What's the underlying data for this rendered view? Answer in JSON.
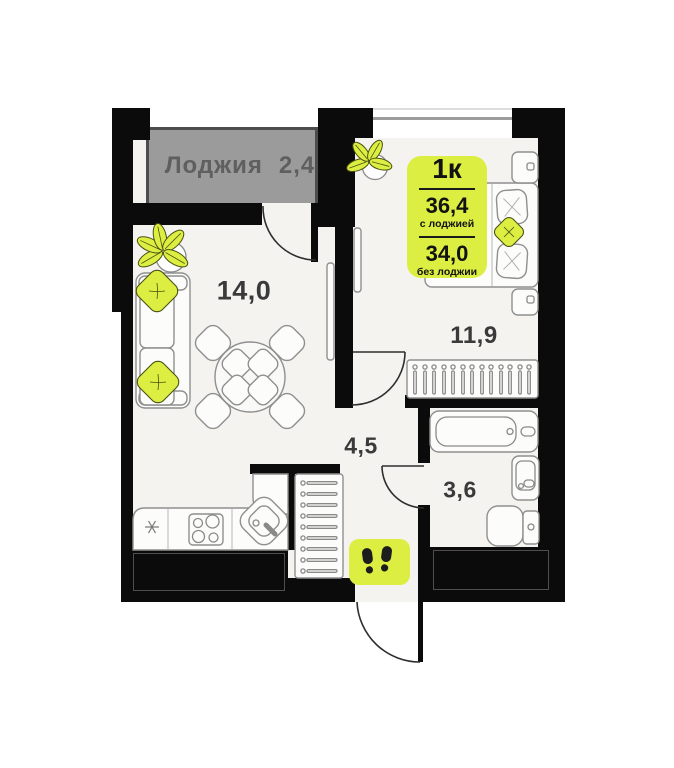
{
  "floorplan": {
    "loggia": {
      "label": "Лоджия",
      "area": "2,4"
    },
    "info_badge": {
      "rooms": "1к",
      "area_total": "36,4",
      "area_total_note": "с лоджией",
      "area_living": "34,0",
      "area_living_note": "без лоджии"
    },
    "rooms": {
      "living": "14,0",
      "bedroom": "11,9",
      "hall": "4,5",
      "bath": "3,6"
    },
    "colors": {
      "accent": "#dcee42",
      "wall": "#0b0b0b",
      "loggia_fill": "#9b9b9b",
      "loggia_border": "#4d4d4d",
      "loggia_text": "#5f5f5f",
      "floor": "#f4f3f0",
      "outline": "#8f8f8f",
      "label": "#3a3a3a"
    }
  }
}
